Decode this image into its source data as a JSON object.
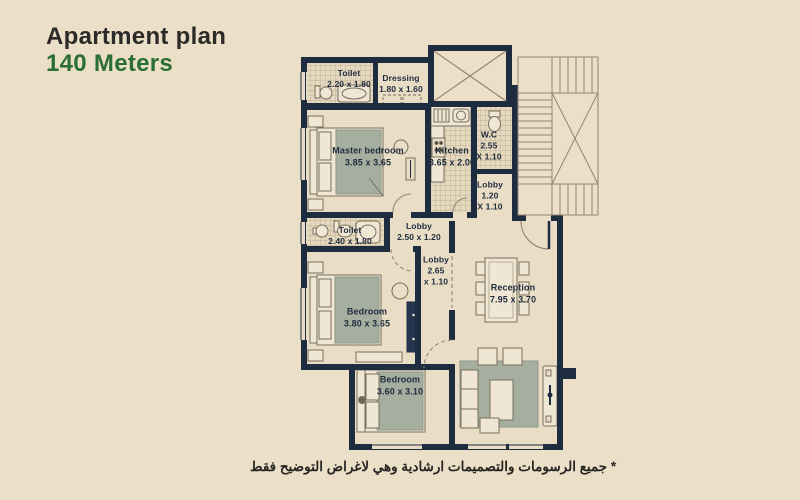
{
  "header": {
    "title": "Apartment plan",
    "subtitle": "140 Meters"
  },
  "footer": {
    "disclaimer": "* جميع الرسومات والتصميمات ارشادية وهي لاغراض التوضيح فقط"
  },
  "colors": {
    "background": "#ecdfc7",
    "wall": "#1e2c40",
    "floor": "#e9ddc6",
    "tile": "#e4d8bf",
    "furniture_cream": "#efe6d3",
    "furniture_gray": "#a6aea0",
    "title_green": "#2a6e33",
    "title_dark": "#2b2a28"
  },
  "plan": {
    "rooms": [
      {
        "id": "toilet-1",
        "name": "Toilet",
        "dims": "2.20 x 1.80"
      },
      {
        "id": "dressing",
        "name": "Dressing",
        "dims": "1.80 x 1.60"
      },
      {
        "id": "master-bedroom",
        "name": "Master bedroom",
        "dims": "3.85 x 3.65"
      },
      {
        "id": "kitchen",
        "name": "Kitchen",
        "dims": "3.65 x 2.00"
      },
      {
        "id": "wc",
        "name": "W.C",
        "dims": "2.55",
        "dims2": "X 1.10"
      },
      {
        "id": "lobby-entry",
        "name": "Lobby",
        "dims": "1.20",
        "dims2": "X 1.10"
      },
      {
        "id": "toilet-2",
        "name": "Toilet",
        "dims": "2.40 x 1.80"
      },
      {
        "id": "lobby-mid",
        "name": "Lobby",
        "dims": "2.50 x 1.20"
      },
      {
        "id": "lobby-corridor",
        "name": "Lobby",
        "dims": "2.65",
        "dims2": "x 1.10"
      },
      {
        "id": "bedroom-2",
        "name": "Bedroom",
        "dims": "3.80 x 3.65"
      },
      {
        "id": "reception",
        "name": "Reception",
        "dims": "7.95 x 3.70"
      },
      {
        "id": "bedroom-3",
        "name": "Bedroom",
        "dims": "3.60 x 3.10"
      }
    ]
  }
}
